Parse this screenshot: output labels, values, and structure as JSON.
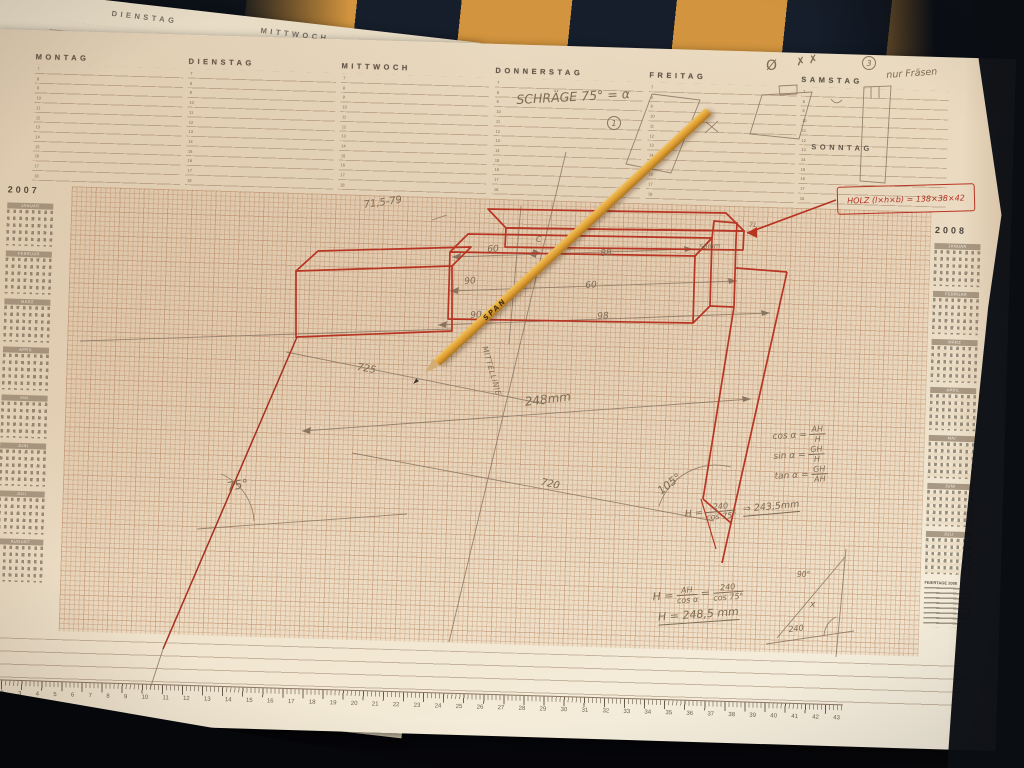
{
  "colors": {
    "paper": "#efe3cd",
    "stripe_orange": "#d2943e",
    "stripe_navy": "#161e2b",
    "red_pen": "#b83524",
    "pencil_gray": "#8a7460",
    "pencil_yellow": "#dd9c31"
  },
  "week": {
    "days": [
      "MONTAG",
      "DIENSTAG",
      "MITTWOCH",
      "DONNERSTAG",
      "FREITAG",
      "SAMSTAG"
    ],
    "sonntag": "SONNTAG",
    "hours": "7\n8\n9\n10\n11\n12\n13\n14\n15\n16\n17\n18",
    "samstag_note": "nur Fräsen"
  },
  "under_sheet": {
    "days": [
      "DIENSTAG",
      "MITTWOCH"
    ]
  },
  "calendars": {
    "left_year": "2007",
    "left_months": [
      "JANUAR",
      "FEBRUAR",
      "MÄRZ",
      "APRIL",
      "MAI",
      "JUNI",
      "JULI",
      "AUGUST"
    ],
    "right_year": "2008",
    "right_months": [
      "JANUAR",
      "FEBRUAR",
      "MÄRZ",
      "APRIL",
      "MAI",
      "JUNI",
      "JULI"
    ],
    "holidays_title": "FEIERTAGE 2008"
  },
  "drawing": {
    "schraege": "SCHRÄGE 75° = α",
    "callout": "HOLZ (l×h×b) = 138×38×42",
    "pencil_brand": "SPAN",
    "dim_top": "71,5-79",
    "dim_60": "60",
    "dim_88": "88",
    "dim_90a": "90",
    "dim_60b": "60",
    "dim_90b": "90",
    "dim_98": "98",
    "label_c": "C",
    "label_50mm": "50mm",
    "label_71": "71",
    "dim_248": "248mm",
    "dim_725": "725",
    "dim_720": "720",
    "angle_75": "75°",
    "angle_105": "105°",
    "midline": "MITTELLINIE",
    "marks": {
      "circled_1": "1",
      "circled_3": "3",
      "slashed_zero": "Ø",
      "x_marks": "✗ ✗"
    },
    "trig": [
      {
        "lhs": "cos α =",
        "num": "AH",
        "den": "H"
      },
      {
        "lhs": "sin α =",
        "num": "GH",
        "den": "H"
      },
      {
        "lhs": "tan α =",
        "num": "GH",
        "den": "AH"
      }
    ],
    "formula_mid": {
      "lhs": "H =",
      "num": "240",
      "den": "cos 75°",
      "result": "⇒ 243,5mm"
    },
    "formula_bottom": {
      "lhs": "H =",
      "num": "AH",
      "den": "cos α",
      "eq": "=",
      "num2": "240",
      "den2": "cos 75°",
      "result": "H = 248,5 mm"
    },
    "corner": {
      "x": "x",
      "v": "240",
      "a": "90°"
    }
  },
  "ruler": {
    "numbers": [
      "1",
      "2",
      "3",
      "4",
      "5",
      "6",
      "7",
      "8",
      "9",
      "10",
      "11",
      "12",
      "13",
      "14",
      "15",
      "16",
      "17",
      "18",
      "19",
      "20",
      "21",
      "22",
      "23",
      "24",
      "25",
      "26",
      "27",
      "28",
      "29",
      "30",
      "31",
      "32",
      "33",
      "34",
      "35",
      "36",
      "37",
      "38",
      "39",
      "40",
      "41",
      "42",
      "43"
    ]
  }
}
